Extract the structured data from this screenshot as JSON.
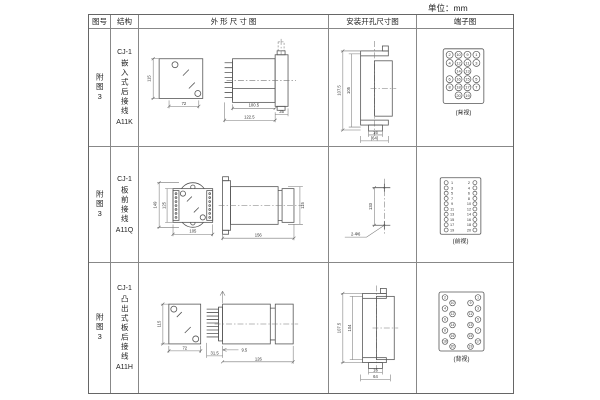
{
  "unit_label": "单位：mm",
  "table": {
    "headers": [
      "图号",
      "结构",
      "外 形 尺 寸 图",
      "安装开孔尺寸图",
      "端子图"
    ]
  },
  "rows": [
    {
      "figure_no": "附图3",
      "structure": {
        "model": "CJ-1",
        "type": "嵌入式后接线",
        "code": "A11K"
      },
      "outline": {
        "front": {
          "height": "115",
          "width": "72"
        },
        "side": {
          "inner": "100.5",
          "flange": "35",
          "total": "122.5"
        }
      },
      "install": {
        "outer_h": "107.5",
        "inner_h": "105",
        "slot_w": "16",
        "total_w": "(64)"
      },
      "terminal": {
        "caption": "(背视)",
        "style": "grid",
        "grid": [
          [
            2,
            10,
            9,
            1
          ],
          [
            4,
            12,
            11,
            3
          ],
          [
            null,
            14,
            13,
            null
          ],
          [
            6,
            16,
            15,
            5
          ],
          [
            8,
            18,
            17,
            7
          ],
          [
            null,
            20,
            19,
            null
          ]
        ]
      }
    },
    {
      "figure_no": "附图3",
      "structure": {
        "model": "CJ-1",
        "type": "板前接线",
        "code": "A11Q"
      },
      "outline": {
        "front": {
          "outer_h": "149",
          "inner_h": "125",
          "width": "105"
        },
        "side": {
          "length": "156",
          "height": "115"
        }
      },
      "install": {
        "spacing": "133",
        "holes": "2-Φ6"
      },
      "terminal": {
        "caption": "(前视)",
        "style": "two-col",
        "left": [
          1,
          3,
          5,
          7,
          9,
          11,
          13,
          15,
          17,
          19
        ],
        "right": [
          2,
          4,
          6,
          8,
          10,
          12,
          14,
          16,
          18,
          20
        ]
      }
    },
    {
      "figure_no": "附图3",
      "structure": {
        "model": "CJ-1",
        "type": "凸出式板后接线",
        "code": "A11H"
      },
      "outline": {
        "front": {
          "height": "115",
          "width": "72"
        },
        "side": {
          "left": "31.5",
          "offset": "9.5",
          "length": "126"
        }
      },
      "install": {
        "outer_h": "107.5",
        "inner_h": "104",
        "slot_w": "16",
        "total_w": "64"
      },
      "terminal": {
        "caption": "(背视)",
        "style": "staggered",
        "left": [
          2,
          10,
          4,
          12,
          6,
          14,
          8,
          16,
          18,
          20
        ],
        "right": [
          1,
          9,
          3,
          11,
          5,
          13,
          7,
          15,
          17,
          19
        ]
      }
    }
  ]
}
